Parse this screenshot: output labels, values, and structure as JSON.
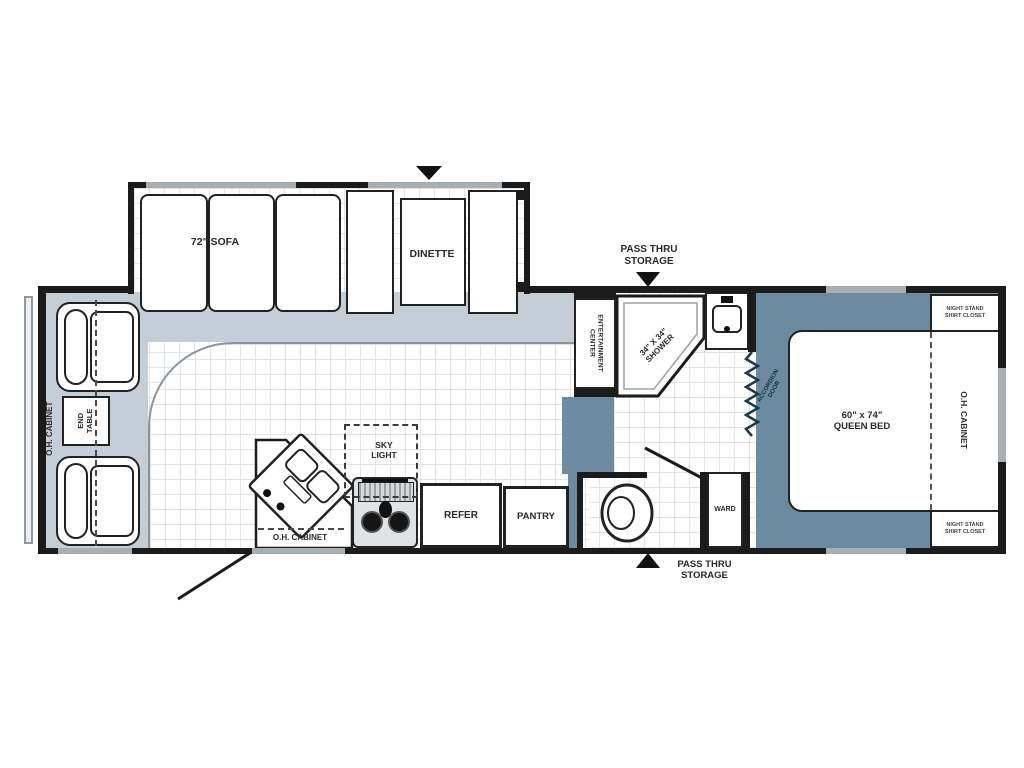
{
  "plan_title": "Travel trailer floor plan",
  "colors": {
    "wall": "#1b1b1b",
    "carpet": "#c4ced7",
    "bedroom_floor": "#6c8ba0",
    "window": "#a9aeb3",
    "background": "#ffffff"
  },
  "labels": {
    "oh_cabinet_left": "O.H. CABINET",
    "end_table": "END\nTABLE",
    "sofa": "72\" SOFA",
    "dinette": "DINETTE",
    "pass_thru_top": "PASS THRU\nSTORAGE",
    "pass_thru_bottom": "PASS THRU\nSTORAGE",
    "entertainment_center": "ENTERTAINMENT\nCENTER",
    "shower": "34\" X 34\"\nSHOWER",
    "accordion_door": "ACCORDION\nDOOR",
    "queen_bed": "60\" x 74\"\nQUEEN BED",
    "oh_cabinet_right": "O.H. CABINET",
    "night_stand_top": "NIGHT STAND\nSHIRT CLOSET",
    "night_stand_bottom": "NIGHT STAND\nSHIRT CLOSET",
    "sky_light": "SKY\nLIGHT",
    "oh_cabinet_kitchen": "O.H. CABINET",
    "refer": "REFER",
    "pantry": "PANTRY",
    "ward": "WARD"
  }
}
